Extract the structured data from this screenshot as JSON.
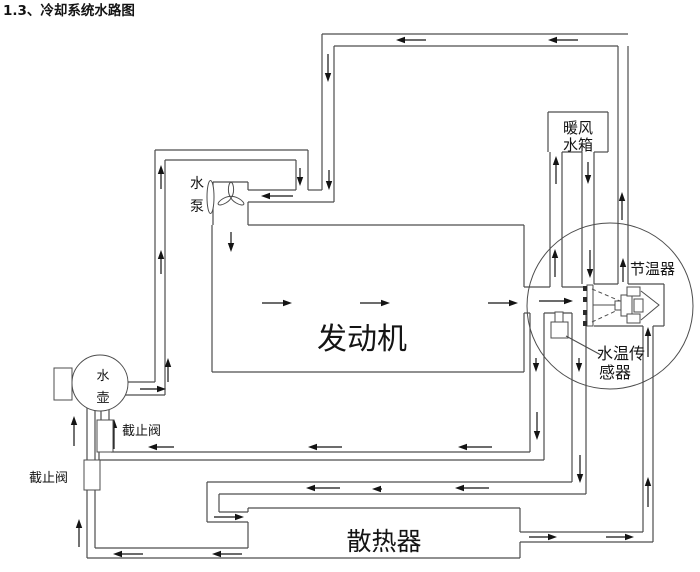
{
  "title": "1.3、冷却系统水路图",
  "components": {
    "water_pump": {
      "label_line1": "水",
      "label_line2": "泵"
    },
    "engine": {
      "label": "发动机"
    },
    "heater_core": {
      "label_line1": "暖风",
      "label_line2": "水箱"
    },
    "thermostat": {
      "label": "节温器"
    },
    "water_temp_sensor": {
      "label_line1": "水温传",
      "label_line2": "感器"
    },
    "water_bottle": {
      "label_line1": "水",
      "label_line2": "壶"
    },
    "shutoff_valve_upper": {
      "label": "截止阀"
    },
    "shutoff_valve_lower": {
      "label": "截止阀"
    },
    "radiator": {
      "label": "散热器"
    }
  },
  "colors": {
    "line": "#4d4d4d",
    "arrow": "#141414",
    "text": "#141414",
    "background": "#ffffff"
  }
}
